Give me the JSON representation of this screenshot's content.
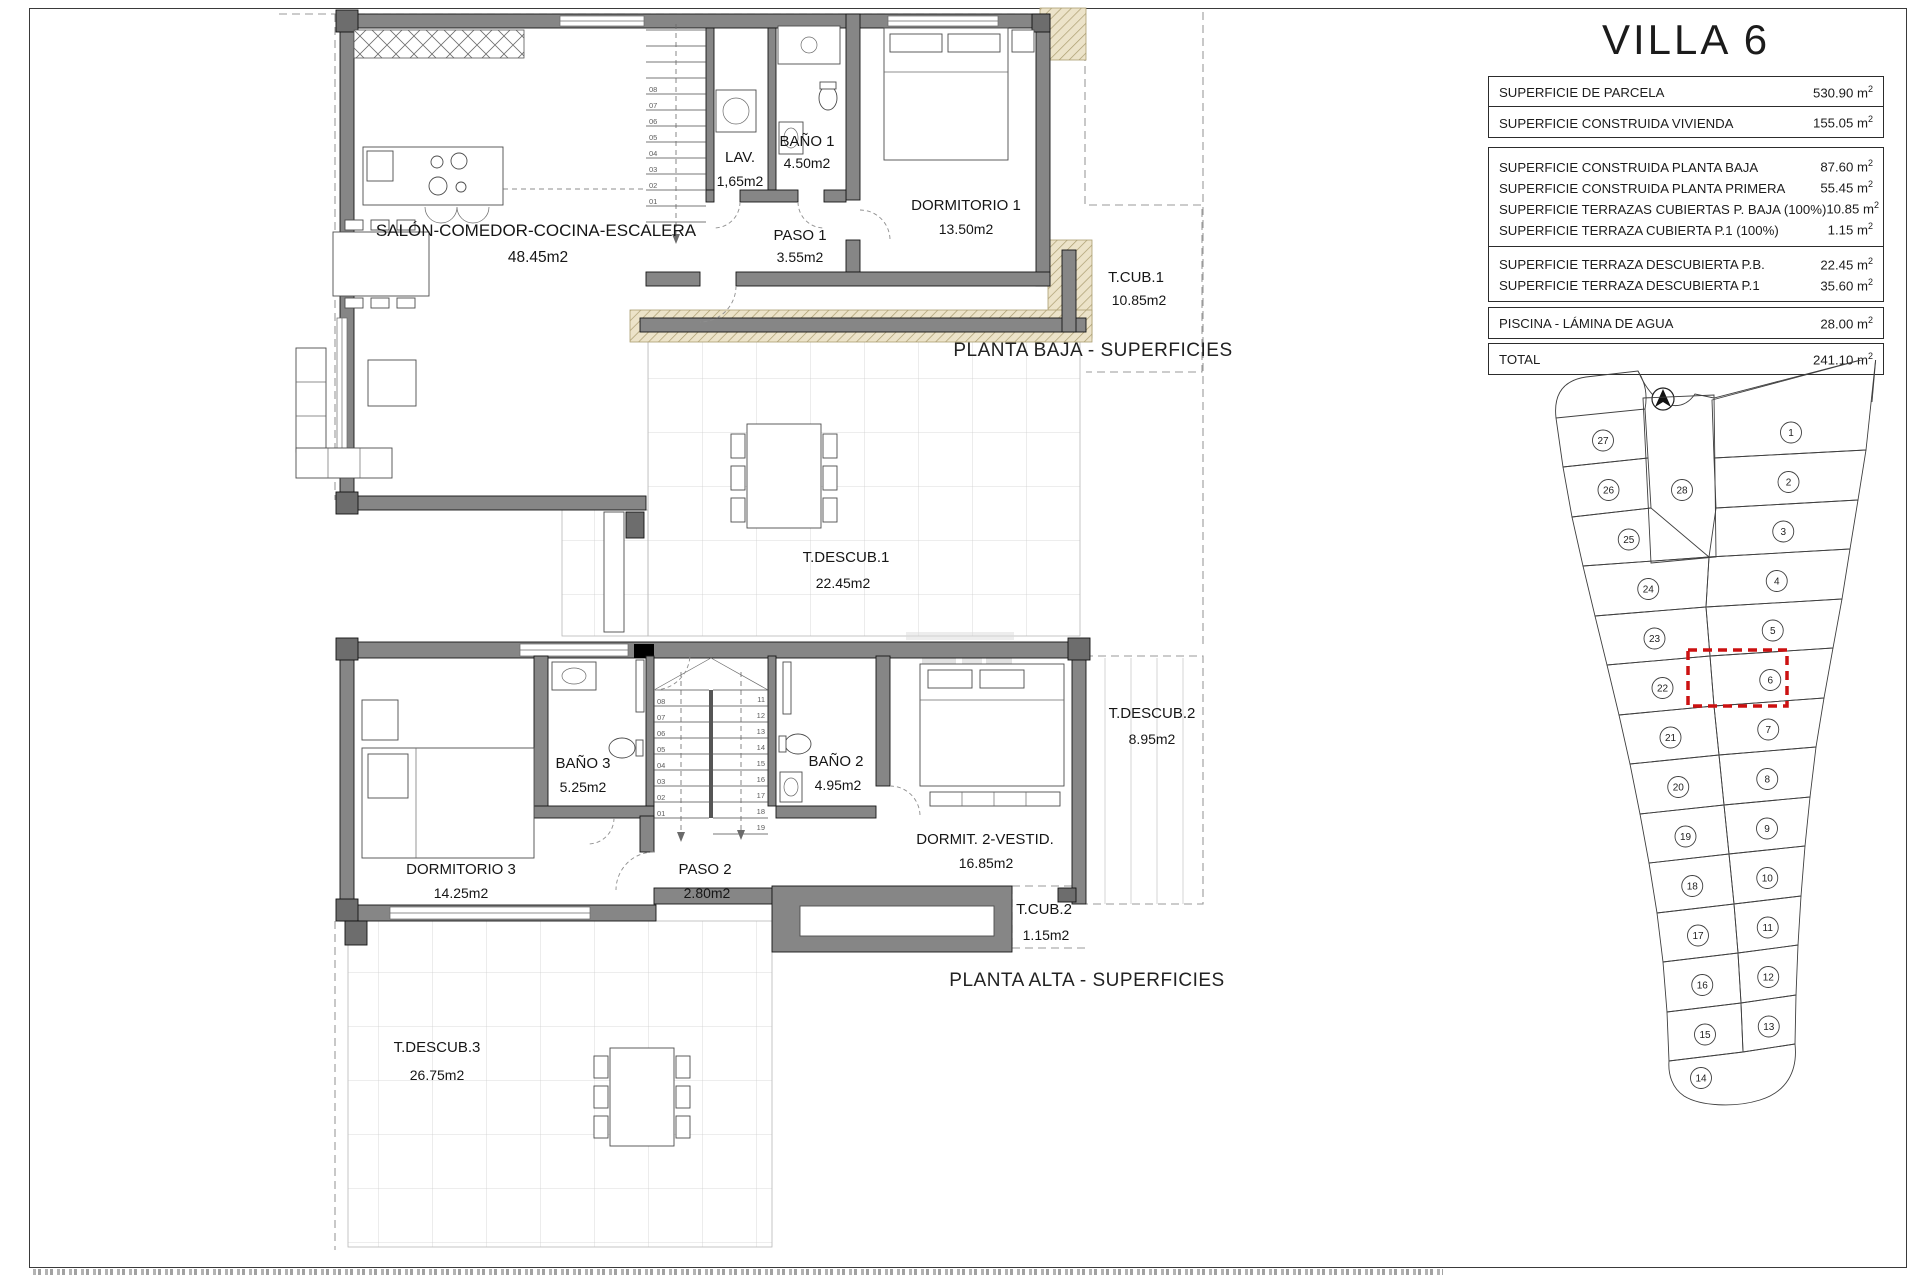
{
  "sheet": {
    "title": "VILLA 6",
    "surface_table": {
      "unit": {
        "symbol": "m",
        "exp": "2"
      },
      "groups": [
        {
          "rows": [
            {
              "label": "SUPERFICIE DE PARCELA",
              "value": "530.90"
            }
          ]
        },
        {
          "rows": [
            {
              "label": "SUPERFICIE CONSTRUIDA VIVIENDA",
              "value": "155.05"
            }
          ]
        },
        {
          "rows": [
            {
              "label": "SUPERFICIE CONSTRUIDA PLANTA BAJA",
              "value": "87.60"
            },
            {
              "label": "SUPERFICIE CONSTRUIDA PLANTA PRIMERA",
              "value": "55.45"
            },
            {
              "label": "SUPERFICIE TERRAZAS CUBIERTAS P. BAJA (100%)",
              "value": "10.85"
            },
            {
              "label": "SUPERFICIE TERRAZA CUBIERTA P.1 (100%)",
              "value": "1.15"
            }
          ]
        },
        {
          "rows": [
            {
              "label": "SUPERFICIE TERRAZA DESCUBIERTA P.B.",
              "value": "22.45"
            },
            {
              "label": "SUPERFICIE TERRAZA DESCUBIERTA P.1",
              "value": "35.60"
            }
          ]
        },
        {
          "rows": [
            {
              "label": "PISCINA - LÁMINA DE AGUA",
              "value": "28.00"
            }
          ]
        },
        {
          "rows": [
            {
              "label": "TOTAL",
              "value": "241.10"
            }
          ]
        }
      ]
    }
  },
  "ground_floor": {
    "caption": "PLANTA BAJA - SUPERFICIES",
    "rooms": {
      "salon": {
        "name": "SALÓN-COMEDOR-COCINA-ESCALERA",
        "area": "48.45m2"
      },
      "lav": {
        "name": "LAV.",
        "area": "1,65m2"
      },
      "bano1": {
        "name": "BAÑO 1",
        "area": "4.50m2"
      },
      "paso1": {
        "name": "PASO 1",
        "area": "3.55m2"
      },
      "dormitorio1": {
        "name": "DORMITORIO 1",
        "area": "13.50m2"
      },
      "tcub1": {
        "name": "T.CUB.1",
        "area": "10.85m2"
      },
      "tdescub1": {
        "name": "T.DESCUB.1",
        "area": "22.45m2"
      }
    },
    "stair_steps": [
      "01",
      "02",
      "03",
      "04",
      "05",
      "06",
      "07",
      "08"
    ]
  },
  "upper_floor": {
    "caption": "PLANTA ALTA - SUPERFICIES",
    "rooms": {
      "dormitorio3": {
        "name": "DORMITORIO 3",
        "area": "14.25m2"
      },
      "bano3": {
        "name": "BAÑO 3",
        "area": "5.25m2"
      },
      "paso2": {
        "name": "PASO 2",
        "area": "2.80m2"
      },
      "bano2": {
        "name": "BAÑO 2",
        "area": "4.95m2"
      },
      "dormitorio2": {
        "name": "DORMIT. 2-VESTID.",
        "area": "16.85m2"
      },
      "tdescub2": {
        "name": "T.DESCUB.2",
        "area": "8.95m2"
      },
      "tcub2": {
        "name": "T.CUB.2",
        "area": "1.15m2"
      },
      "tdescub3": {
        "name": "T.DESCUB.3",
        "area": "26.75m2"
      }
    },
    "stair_steps_left": [
      "01",
      "02",
      "03",
      "04",
      "05",
      "06",
      "07",
      "08"
    ],
    "stair_steps_right": [
      "11",
      "12",
      "13",
      "14",
      "15",
      "16",
      "17",
      "18",
      "19"
    ]
  },
  "site_plan": {
    "highlighted_plot": "6",
    "highlight_color": "#cc1111",
    "plots_left": [
      "27",
      "26",
      "25",
      "24",
      "23",
      "22",
      "21",
      "20",
      "19",
      "18",
      "17",
      "16",
      "15"
    ],
    "plots_right": [
      "1",
      "2",
      "3",
      "4",
      "5",
      "6",
      "7",
      "8",
      "9",
      "10",
      "11",
      "12",
      "13"
    ],
    "plot_middle": "28",
    "plot_bottom": "14"
  }
}
